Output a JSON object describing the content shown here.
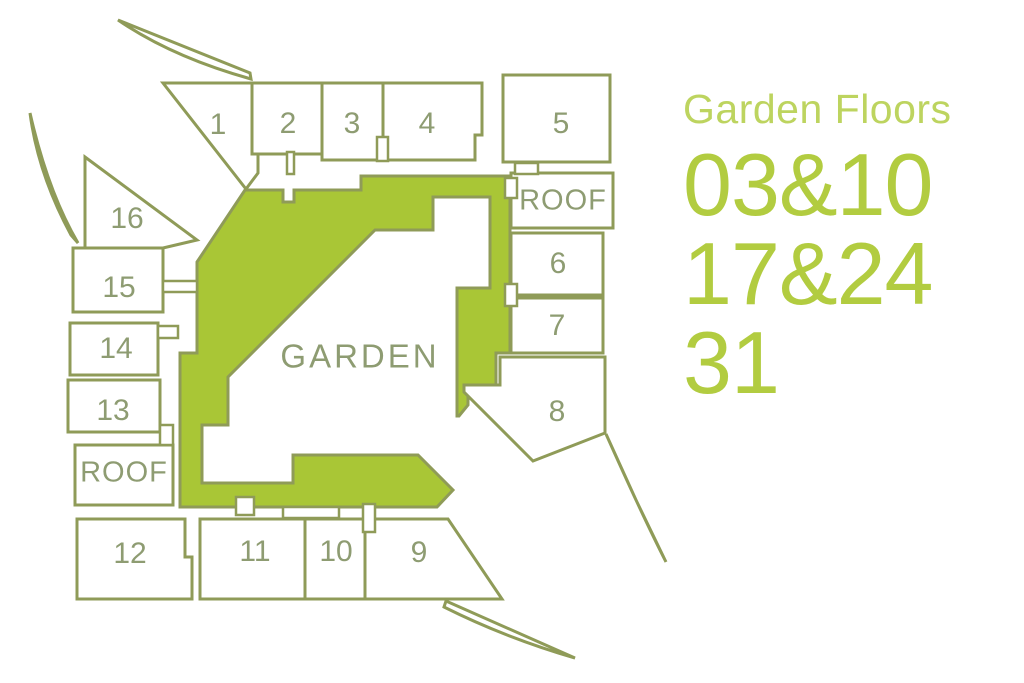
{
  "colors": {
    "garden_fill": "#a9c636",
    "outline": "#8f9b58",
    "plan_label": "#8e9c72",
    "panel_title": "#bdd45f",
    "panel_number": "#b2cc40",
    "background": "#ffffff"
  },
  "plan": {
    "garden": {
      "label": "GARDEN"
    },
    "roof_left": {
      "label": "ROOF"
    },
    "roof_right": {
      "label": "ROOF"
    },
    "units": [
      {
        "id": "1",
        "label": "1"
      },
      {
        "id": "2",
        "label": "2"
      },
      {
        "id": "3",
        "label": "3"
      },
      {
        "id": "4",
        "label": "4"
      },
      {
        "id": "5",
        "label": "5"
      },
      {
        "id": "6",
        "label": "6"
      },
      {
        "id": "7",
        "label": "7"
      },
      {
        "id": "8",
        "label": "8"
      },
      {
        "id": "9",
        "label": "9"
      },
      {
        "id": "10",
        "label": "10"
      },
      {
        "id": "11",
        "label": "11"
      },
      {
        "id": "12",
        "label": "12"
      },
      {
        "id": "13",
        "label": "13"
      },
      {
        "id": "14",
        "label": "14"
      },
      {
        "id": "15",
        "label": "15"
      },
      {
        "id": "16",
        "label": "16"
      }
    ]
  },
  "panel": {
    "title": "Garden Floors",
    "floors": [
      "03&10",
      "17&24",
      "31"
    ]
  }
}
